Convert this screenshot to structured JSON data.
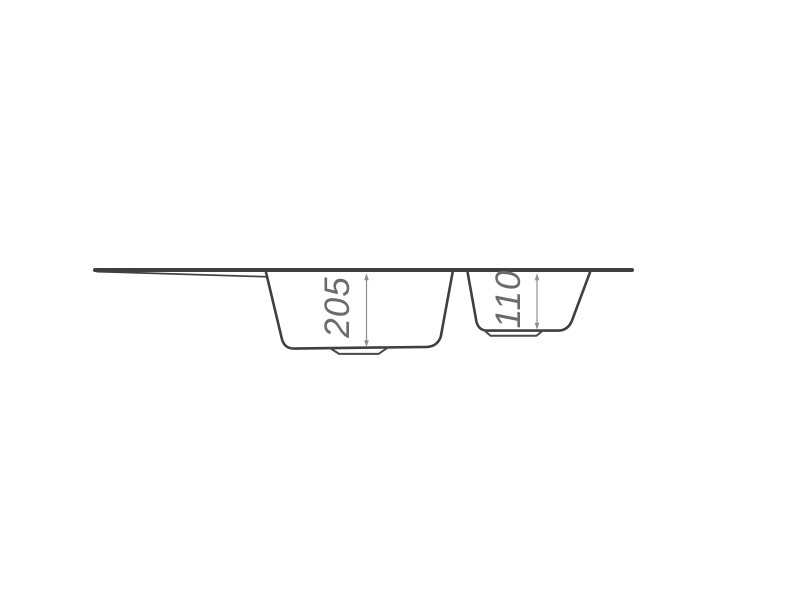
{
  "diagram": {
    "kind": "technical-drawing",
    "subject": "kitchen sink side-view cross-section with one and a half bowls and drainboard",
    "labels": {
      "main_bowl_depth": "205",
      "secondary_bowl_depth": "110"
    },
    "colors": {
      "background": "#ffffff",
      "outline": "#3f3f41",
      "dimension_line": "#8f8f8f",
      "dimension_text": "#6b6b6b"
    }
  }
}
